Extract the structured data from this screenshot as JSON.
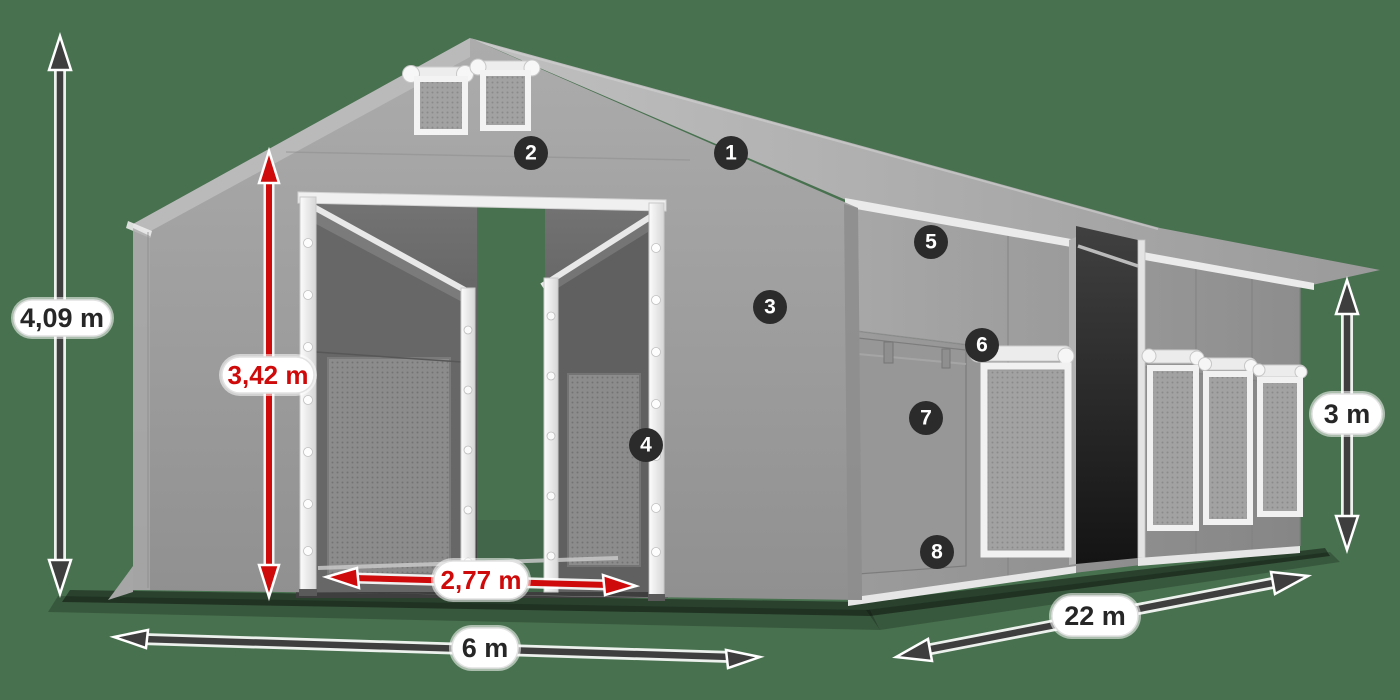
{
  "dimensions": {
    "total_height": "4,09 m",
    "door_height": "3,42 m",
    "door_width": "2,77 m",
    "front_width": "6 m",
    "length": "22 m",
    "side_wall_height": "3 m"
  },
  "markers": [
    "1",
    "2",
    "3",
    "4",
    "5",
    "6",
    "7",
    "8"
  ],
  "colors": {
    "background": "#48714f",
    "dimension_arrow": "#3e3e3e",
    "dimension_arrow_red": "#cf0a0a",
    "marker_badge": "#2b2b2b",
    "tent_tarp": "#9b9b9b",
    "label_pill": "#ffffff"
  }
}
